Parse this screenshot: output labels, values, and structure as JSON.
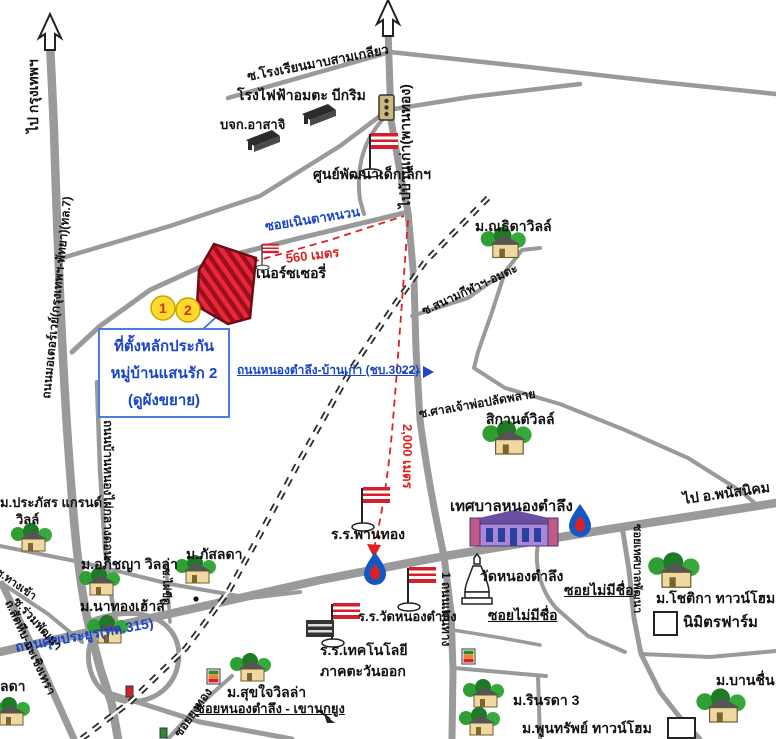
{
  "colors": {
    "road": "#9a9a9a",
    "accent_blue": "#1a45c8",
    "accent_red": "#e02020",
    "parcel_red": "#c81626",
    "marker_yellow": "#ffd92b"
  },
  "callout": {
    "line1": "ที่ตั้งหลักประกัน",
    "line2": "หมู่บ้านแสนรัก 2",
    "line3": "(ดูผังขยาย)"
  },
  "markers": {
    "site1": "1",
    "site2": "2"
  },
  "labels": {
    "to_bangkok": "ไป กรุงเทพฯ",
    "to_bankao": "ไปบ้านเก่า(พานทอง)",
    "school_soi": "ซ.โรงเรียนมาบสามเกลียว",
    "power_plant": "โรงไฟฟ้าอมตะ บีกริม",
    "asahi": "บจก.อาสาจิ",
    "child_center": "ศูนย์พัฒนาเด็กเล็กฯ",
    "noen_ta_nuan": "ซอยเนินตาหนวน",
    "m560": "560 เมตร",
    "nursery": "เนอร์ซเซอรี่",
    "motorway": "ถนนมอเตอร์เวย์(กรุงเทพฯ-พัทยา)(ทล.7)",
    "chb3022": "ถนนหนองตำลึง-บ้านเก่า (ชบ.3022)",
    "m2000": "2,000 เมตร",
    "thida": "ม.ณธิดาวิลล์",
    "sanamkila": "ซ.สนามกีฬาฯ-อมตะ",
    "sanchao": "ซ.ศาลเจ้าพ่อปลัดพลาย",
    "sikan": "สิกานต์วิลล์",
    "municipality": "เทศบาลหนองตำลึง",
    "panthong_school": "ร.ร.พานทอง",
    "wat": "วัดหนองตำลึง",
    "wat_school": "ร.ร.วัดหนองตำลึง",
    "tech_school_1": "ร.ร.เทคโนโลยี",
    "tech_school_2": "ภาคตะวันออก",
    "sukprayoon": "ถนนศุขประยูร(ทล.315)",
    "phanat": "ไป อ.พนัสนิคม",
    "soi_no_name_1": "ซอยไม่มีชื่อ",
    "soi_no_name_2": "ซอยไม่มีชื่อ",
    "soi_thetsaban": "ซอยเทศบาลพัฒนา",
    "chotika": "ม.โชติกา ทาวน์โฮม",
    "nimit": "นิมิตรฟาร์ม",
    "rinrada": "ม.รินรดา 3",
    "poonsap": "ม.พูนทรัพย์ ทาวน์โฮม",
    "banchuen": "ม.บานชื่น",
    "main_rd_1": "1 ถนนเมนทาง",
    "sukjai": "ม.สุขใจวิลล่า",
    "soi_khao": "ซอยหนองตำลึง - เขานกยูง",
    "yungthong": "ซอยยุงทอง",
    "nathong": "ม.นาทองเฮ้าส์",
    "apichaya": "ม.อภิชญา วิลล่า",
    "prapasorn_1": "ม.ประภัสร แกรนด์",
    "prapasorn_2": "วิลล์",
    "ruamphat": "ซ.ร่วมพัฒนา",
    "sattahip": "ถ.สัตหีบ-ฉะเชิงเทรา",
    "tangkhao": "ซ.ทางเข้า",
    "phatsalada": "ม.ภัสลดา",
    "phai_khit": "ซ.ไผ่ขีด",
    "lada_partial": "ลดา"
  },
  "icons": [
    "up-arrow-icon",
    "flag-icon",
    "gas-station-drop-icon",
    "seven-eleven-icon",
    "tree-house-icon",
    "factory-icon",
    "chedi-icon",
    "municipal-building-icon",
    "traffic-light-icon",
    "railway-line",
    "site-parcel",
    "farm-square-icon"
  ]
}
